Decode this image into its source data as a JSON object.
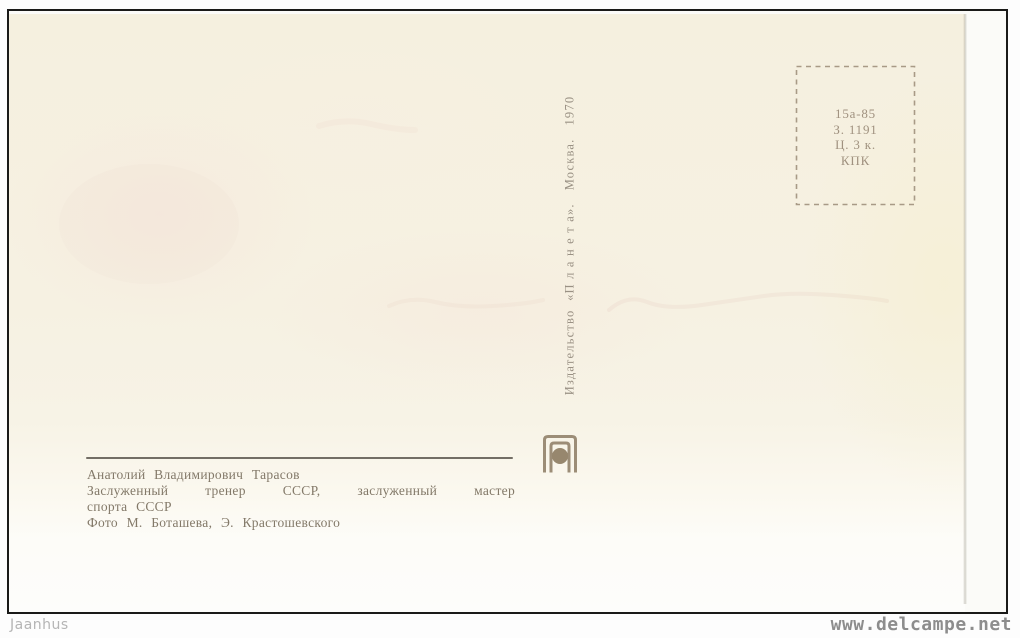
{
  "postcard": {
    "stamp_box": {
      "line1": "15а-85",
      "line2": "З. 1191",
      "line3": "Ц. 3 к.",
      "line4": "КПК"
    },
    "publisher": {
      "imprint": "Издательство  «П л а н е т а».   Москва.   1970",
      "logo": "planeta-open-book-globe"
    },
    "caption": {
      "name": "Анатолий Владимирович Тарасов",
      "title_line1": "Заслуженный тренер СССР, заслуженный мастер",
      "title_line2": "спорта СССР",
      "credit": "Фото М. Боташева, Э. Крастошевского"
    }
  },
  "watermarks": {
    "left": "Jaanhus",
    "right": "www.delcampe.net"
  },
  "colors": {
    "card_background": "#f5f0e0",
    "caption_ink": "#837969",
    "stamp_ink": "#a0917f",
    "imprint_ink": "#9a9184",
    "logo_ink": "#9c8d77",
    "frame": "#1a1a18",
    "watermark_left": "#b5b5b5",
    "watermark_right": "#8d8d8d"
  }
}
